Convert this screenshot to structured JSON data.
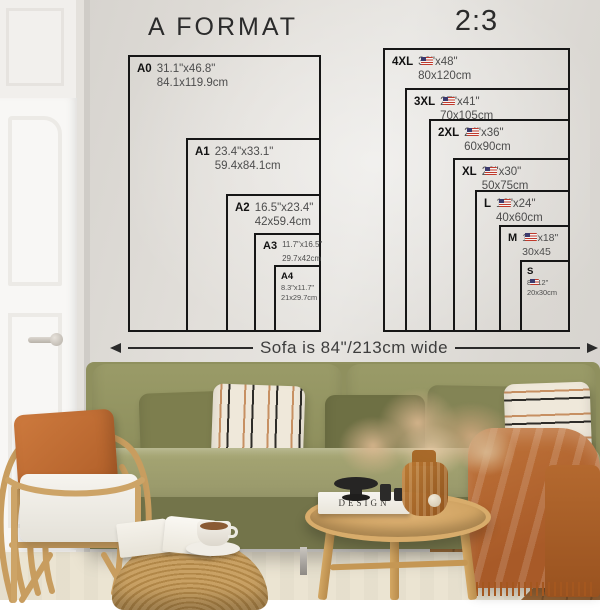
{
  "left_chart": {
    "title": "A FORMAT",
    "items": [
      {
        "code": "A0",
        "inches": "31.1\"x46.8\"",
        "cm": "84.1x119.9cm"
      },
      {
        "code": "A1",
        "inches": "23.4\"x33.1\"",
        "cm": "59.4x84.1cm"
      },
      {
        "code": "A2",
        "inches": "16.5\"x23.4\"",
        "cm": "42x59.4cm"
      },
      {
        "code": "A3",
        "inches": "11.7\"x16.5\"",
        "cm": "29.7x42cm"
      },
      {
        "code": "A4",
        "inches": "8.3\"x11.7\"",
        "cm": "21x29.7cm"
      }
    ]
  },
  "right_chart": {
    "title": "2:3",
    "items": [
      {
        "code": "4XL",
        "inches": "32\"x48\"",
        "cm": "80x120cm",
        "flag": "us-flag"
      },
      {
        "code": "3XL",
        "inches": "27\"x41\"",
        "cm": "70x105cm",
        "flag": "us-flag"
      },
      {
        "code": "2XL",
        "inches": "24\"x36\"",
        "cm": "60x90cm",
        "flag": "us-flag"
      },
      {
        "code": "XL",
        "inches": "20\"x30\"",
        "cm": "50x75cm",
        "flag": "us-flag"
      },
      {
        "code": "L",
        "inches": "16\"x24\"",
        "cm": "40x60cm",
        "flag": "us-flag"
      },
      {
        "code": "M",
        "inches": "12\"x18\"",
        "cm": "30x45",
        "flag": "us-flag"
      },
      {
        "code": "S",
        "inches": "8\"x12\"",
        "cm": "20x30cm",
        "flag": "us-flag"
      }
    ]
  },
  "sofa_note": {
    "text": "Sofa is 84\"/213cm wide"
  },
  "scene": {
    "coffee_table_book_title": "DESIGN",
    "colors": {
      "wall": "#e2dfda",
      "door_white": "#f8f7f5",
      "sofa_olive": "#8f905e",
      "pillow_rust": "#c06c34",
      "throw_rust": "#b4692f",
      "rattan": "#c89d5f",
      "rug_cream": "#ebe4d2",
      "floor_wood": "#9b6b41",
      "diagram_line": "#161616"
    }
  }
}
